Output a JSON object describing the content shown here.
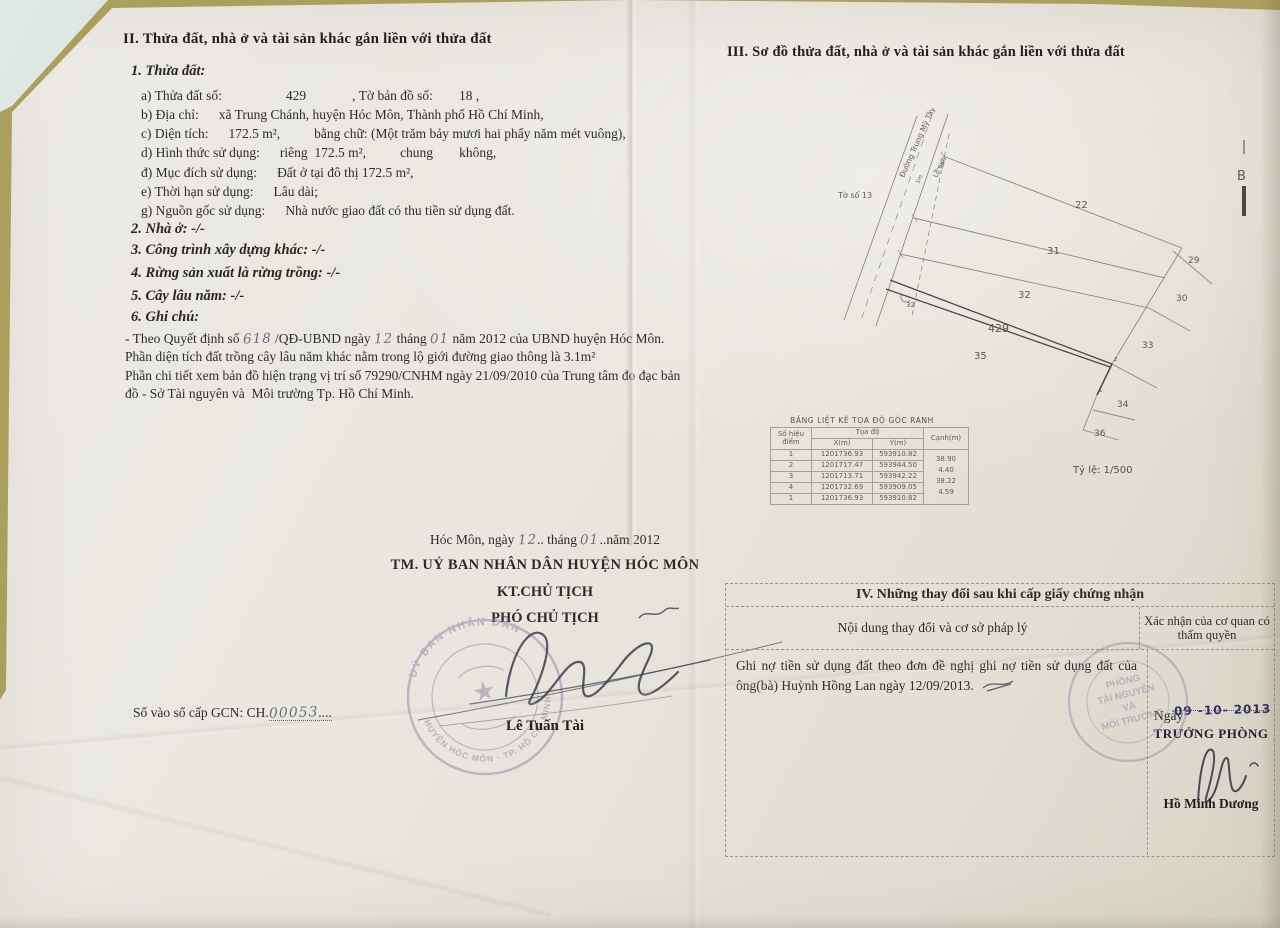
{
  "section2": {
    "heading": "II. Thửa đất, nhà ở và tài sản khác gắn liền với thửa đất",
    "sub1": "1. Thửa đất:",
    "line_a": {
      "label": "a) Thửa đất số:",
      "value": "429",
      "label2": ", Tờ bản đồ số:",
      "value2": "18 ,"
    },
    "line_b": {
      "label": "b) Địa chỉ:",
      "value": "xã Trung Chánh, huyện Hóc Môn, Thành phố Hồ Chí Minh,"
    },
    "line_c": {
      "label": "c) Diện tích:",
      "value": "172.5 m²,",
      "label2": "bằng chữ: (Một trăm bảy mươi hai phẩy năm mét vuông),"
    },
    "line_d": {
      "label": "d) Hình thức sử dụng:",
      "value": "riêng  172.5 m²,",
      "label2": "chung",
      "value2": "không,"
    },
    "line_dd": {
      "label": "đ) Mục đích sử dụng:",
      "value": "Đất ở tại đô thị 172.5 m²,"
    },
    "line_e": {
      "label": "e) Thời hạn sử dụng:",
      "value": "Lâu dài;"
    },
    "line_g": {
      "label": "g) Nguồn gốc sử dụng:",
      "value": "Nhà nước giao đất có thu tiền sử dụng đất."
    },
    "item2": "2. Nhà ở: -/-",
    "item3": "3. Công trình xây dựng khác: -/-",
    "item4": "4. Rừng sản xuất là rừng trồng: -/-",
    "item5": "5. Cây lâu năm: -/-",
    "item6": "6. Ghi chú:",
    "note1": {
      "p1": "- Theo Quyết định số ",
      "hw1": "618",
      "p2": " /QĐ-UBND ngày ",
      "hw2": "12",
      "p3": " tháng ",
      "hw3": "01",
      "p4": " năm 2012 của UBND huyện Hóc Môn."
    },
    "note2": "Phần diện tích đất trồng cây lâu năm khác nằm trong lộ giới đường giao thông là 3.1m²",
    "note3": "Phần chi tiết xem bản đồ hiện trạng vị trí số 79290/CNHM ngày 21/09/2010 của Trung tâm đo đạc bản đồ - Sở Tài nguyên và  Môi trường Tp. Hồ Chí Minh."
  },
  "section3": {
    "heading": "III. Sơ đồ thửa đất, nhà ở và tài sản khác gắn liền với thửa đất",
    "diagram": {
      "sheet_ref": "Tờ số 13",
      "road_name": "Đường Trung Mỹ Tây 4",
      "setback_label": "Lộ giới",
      "setback_width": "1m",
      "orientation_mark": "B",
      "parcel_main": "429",
      "parcel_22": "22",
      "parcel_31": "31",
      "parcel_32": "32",
      "parcel_35": "35",
      "parcel_29": "29",
      "parcel_30": "30",
      "parcel_33": "33",
      "parcel_34": "34",
      "parcel_36": "36",
      "point_1": "1",
      "point_2": "2",
      "point_32": "32",
      "scale": "Tỷ lệ: 1/500"
    },
    "coord_table": {
      "title": "BẢNG LIỆT KÊ TỌA ĐỘ GÓC RANH",
      "col_point1": "Số hiệu",
      "col_point2": "điểm",
      "col_coords": "Tọa độ",
      "col_x": "X(m)",
      "col_y": "Y(m)",
      "col_edge": "Cạnh(m)",
      "rows": [
        {
          "id": "1",
          "x": "1201736.93",
          "y": "593910.82"
        },
        {
          "id": "2",
          "x": "1201717.47",
          "y": "593944.50"
        },
        {
          "id": "3",
          "x": "1201713.71",
          "y": "593942.22"
        },
        {
          "id": "4",
          "x": "1201732.69",
          "y": "593909.05"
        },
        {
          "id": "1",
          "x": "1201736.93",
          "y": "593910.82"
        }
      ],
      "edges": [
        "38.90",
        "4.40",
        "38.22",
        "4.59"
      ]
    }
  },
  "approval": {
    "place_date": {
      "p1": "Hóc Môn, ngày ",
      "hw1": "12",
      "p2": ".. tháng ",
      "hw2": "01",
      "p3": "..năm 2012"
    },
    "authority_line1": "TM. UỶ BAN NHÂN DÂN HUYỆN HÓC MÔN",
    "authority_line2": "KT.CHỦ TỊCH",
    "authority_line3": "PHÓ CHỦ TỊCH",
    "signer": "Lê Tuấn Tài",
    "registry": {
      "p1": "Số vào sổ cấp GCN: CH.",
      "hw": "00053",
      "dots": "...."
    },
    "stamp": {
      "ring_top": "UỶ BAN NHÂN DÂN",
      "ring_bottom": "HUYỆN HÓC MÔN · TP. HỒ CHÍ MINH",
      "star": "★"
    }
  },
  "section4": {
    "title": "IV. Những thay đổi sau khi cấp giấy chứng nhận",
    "col_content": "Nội dung thay đổi và cơ sở pháp lý",
    "col_confirm": "Xác nhận của cơ quan có thẩm quyền",
    "entry": "Ghi nợ tiền sử dụng đất theo đơn đề nghị ghi nợ tiền sử dụng đất của ông(bà) Huỳnh Hồng Lan ngày 12/09/2013.",
    "confirm": {
      "ngay": "Ngày",
      "date": "09 -10- 2013",
      "title": "TRƯỞNG PHÒNG",
      "signer": "Hồ Minh Dương",
      "stamp_line1": "PHÒNG",
      "stamp_line2": "TÀI NGUYÊN",
      "stamp_line3": "VÀ",
      "stamp_line4": "MÔI TRƯỜNG"
    }
  }
}
